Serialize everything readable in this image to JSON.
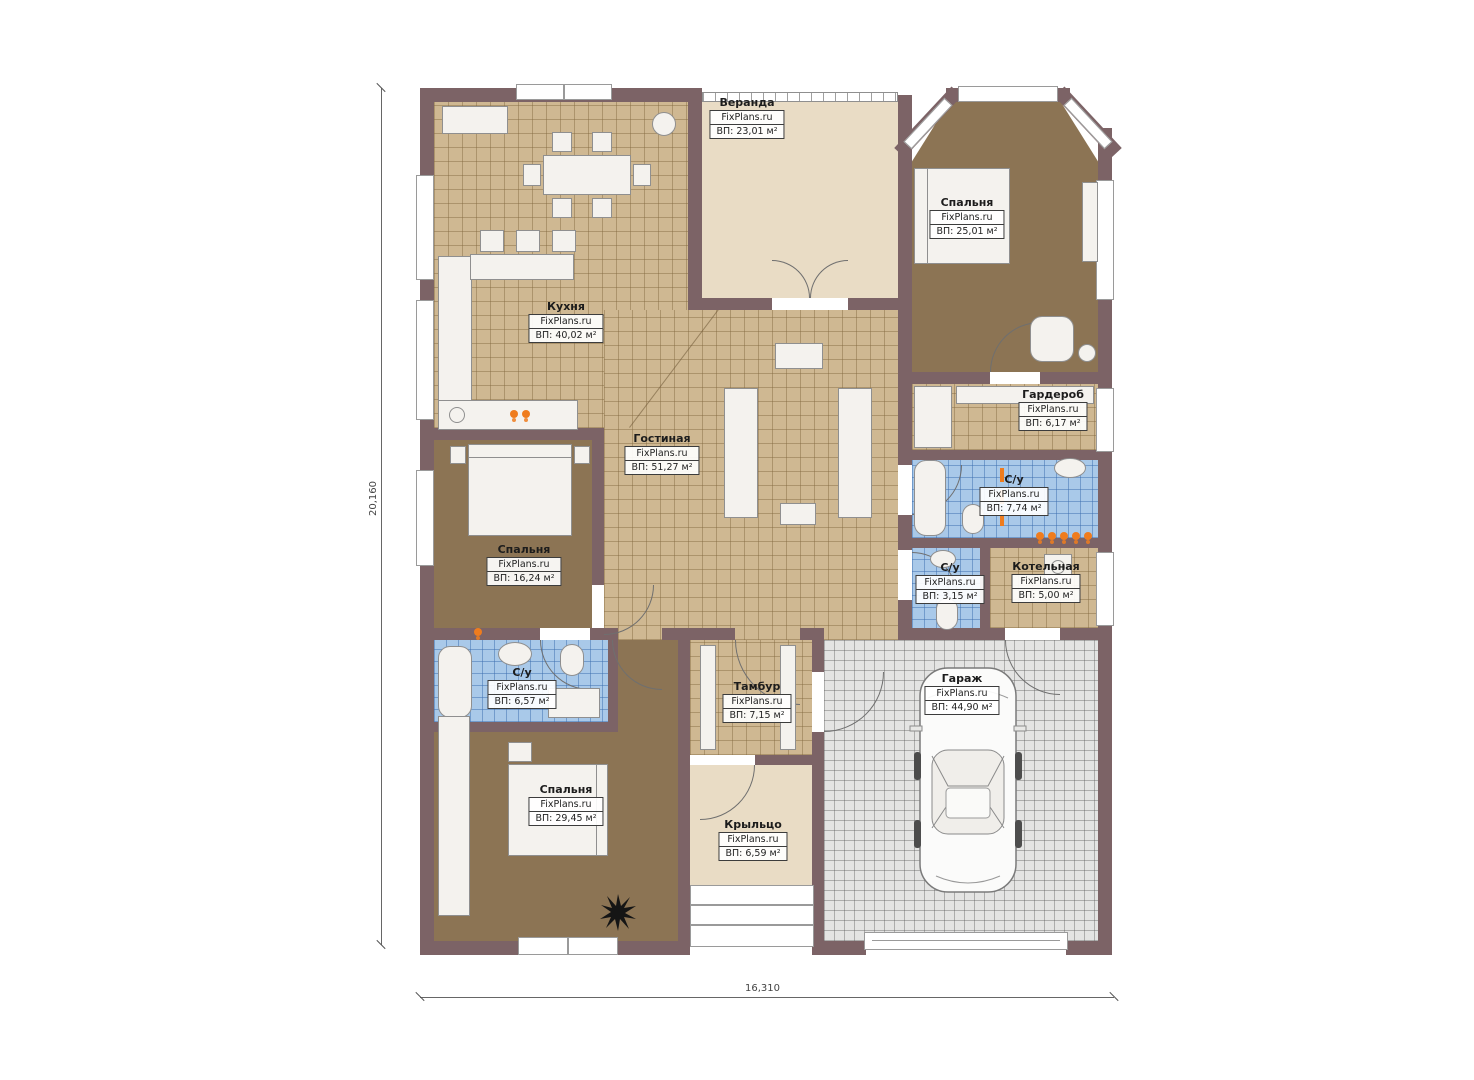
{
  "site": "FixPlans.ru",
  "dimensions": {
    "height_label": "20,160",
    "width_label": "16,310"
  },
  "rooms": [
    {
      "name": "Веранда",
      "area": "ВП: 23,01 м²"
    },
    {
      "name": "Спальня",
      "area": "ВП: 25,01 м²"
    },
    {
      "name": "Кухня",
      "area": "ВП: 40,02 м²"
    },
    {
      "name": "Гостиная",
      "area": "ВП: 51,27 м²"
    },
    {
      "name": "Гардероб",
      "area": "ВП: 6,17 м²"
    },
    {
      "name": "С/у",
      "area": "ВП: 7,74 м²"
    },
    {
      "name": "Спальня",
      "area": "ВП: 16,24 м²"
    },
    {
      "name": "С/у",
      "area": "ВП: 3,15 м²"
    },
    {
      "name": "Котельная",
      "area": "ВП: 5,00 м²"
    },
    {
      "name": "С/у",
      "area": "ВП: 6,57 м²"
    },
    {
      "name": "Тамбур",
      "area": "ВП: 7,15 м²"
    },
    {
      "name": "Гараж",
      "area": "ВП: 44,90 м²"
    },
    {
      "name": "Спальня",
      "area": "ВП: 29,45 м²"
    },
    {
      "name": "Крыльцо",
      "area": "ВП: 6,59 м²"
    }
  ],
  "colors": {
    "wall": "#7c6366",
    "tile_tan": "#cfb892",
    "floor_brown": "#8c7454",
    "tile_blue": "#a9c9e9",
    "floor_cream": "#e9dcc5",
    "garage_tile": "#e4e4e3",
    "radiator_accent": "#ef7c1e",
    "furniture": "#f4f2ee"
  }
}
